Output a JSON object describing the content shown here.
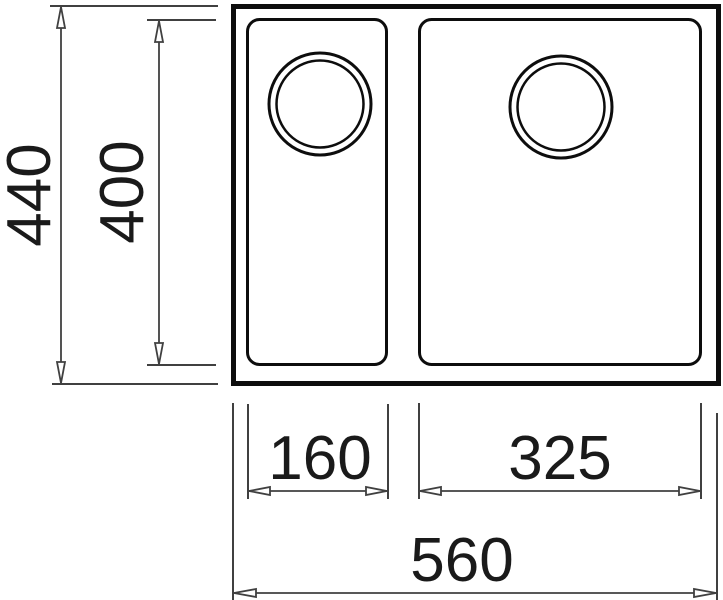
{
  "drawing": {
    "kind": "sink-dimension-diagram-top-view",
    "colors": {
      "outline": "#0d0d0d",
      "dimension": "#404040",
      "text": "#1a1a1a",
      "background": "#ffffff"
    },
    "labels": {
      "overall_height": "440",
      "bowl_height": "400",
      "left_bowl_width": "160",
      "right_bowl_width": "325",
      "overall_width": "560"
    }
  }
}
